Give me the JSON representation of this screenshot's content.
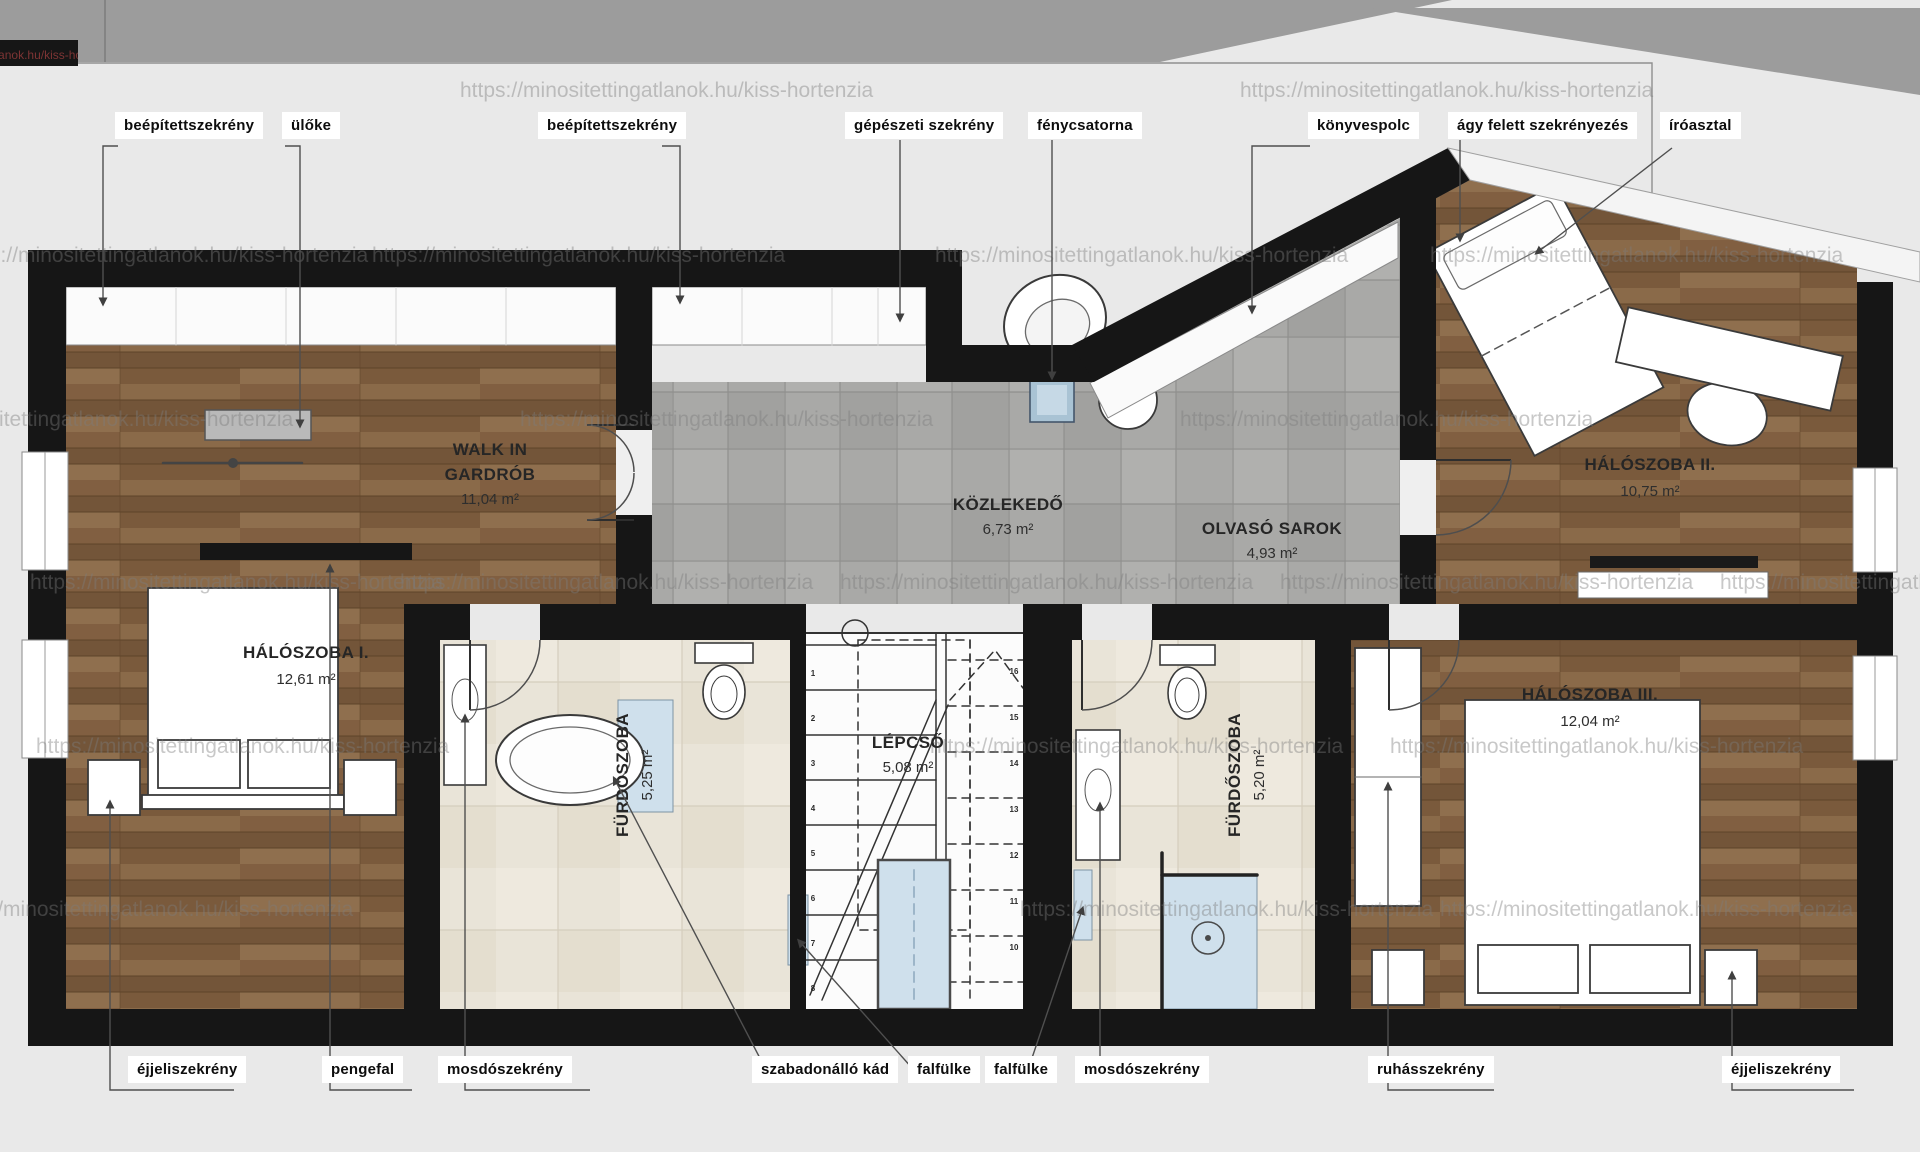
{
  "watermark": {
    "url_text": "https://minositettingatlanok.hu/kiss-hortenzia"
  },
  "rooms": {
    "gardrob": {
      "name": "WALK IN",
      "name2": "GARDRÓB",
      "area": "11,04 m²"
    },
    "kozlekedo": {
      "name": "KÖZLEKEDŐ",
      "area": "6,73 m²"
    },
    "olvaso": {
      "name": "OLVASÓ SAROK",
      "area": "4,93 m²"
    },
    "haloszoba1": {
      "name": "HÁLÓSZOBA I.",
      "area": "12,61 m²"
    },
    "haloszoba2": {
      "name": "HÁLÓSZOBA II.",
      "area": "10,75 m²"
    },
    "haloszoba3": {
      "name": "HÁLÓSZOBA III.",
      "area": "12,04 m²"
    },
    "furdoszoba1": {
      "name": "FÜRDŐSZOBA",
      "area": "5,25 m²"
    },
    "furdoszoba2": {
      "name": "FÜRDŐSZOBA",
      "area": "5,20 m²"
    },
    "lepcso": {
      "name": "LÉPCSŐ",
      "area": "5,08 m²"
    }
  },
  "callouts_top": [
    {
      "label": "beépítettszekrény"
    },
    {
      "label": "ülőke"
    },
    {
      "label": "beépítettszekrény"
    },
    {
      "label": "gépészeti szekrény"
    },
    {
      "label": "fénycsatorna"
    },
    {
      "label": "könyvespolc"
    },
    {
      "label": "ágy felett szekrényezés"
    },
    {
      "label": "íróasztal"
    }
  ],
  "callouts_bottom": [
    {
      "label": "éjjeliszekrény"
    },
    {
      "label": "pengefal"
    },
    {
      "label": "mosdószekrény"
    },
    {
      "label": "szabadonálló kád"
    },
    {
      "label": "falfülke"
    },
    {
      "label": "falfülke"
    },
    {
      "label": "mosdószekrény"
    },
    {
      "label": "ruhásszekrény"
    },
    {
      "label": "éjjeliszekrény"
    }
  ],
  "stairs": {
    "steps_down": [
      "1",
      "2",
      "3",
      "4",
      "5",
      "6",
      "7",
      "8"
    ],
    "steps_up": [
      "10",
      "11",
      "12",
      "13",
      "14",
      "15",
      "16"
    ]
  },
  "colors": {
    "wall": "#161616",
    "background": "#e9e9e9",
    "band_gray": "#9c9c9c",
    "wood": "#7c5d3f",
    "tile_gray": "#a9a9a7",
    "tile_beige": "#e9e4d8",
    "glass_blue": "#cfe0ec",
    "skylight_blue": "#a9c3d4"
  }
}
